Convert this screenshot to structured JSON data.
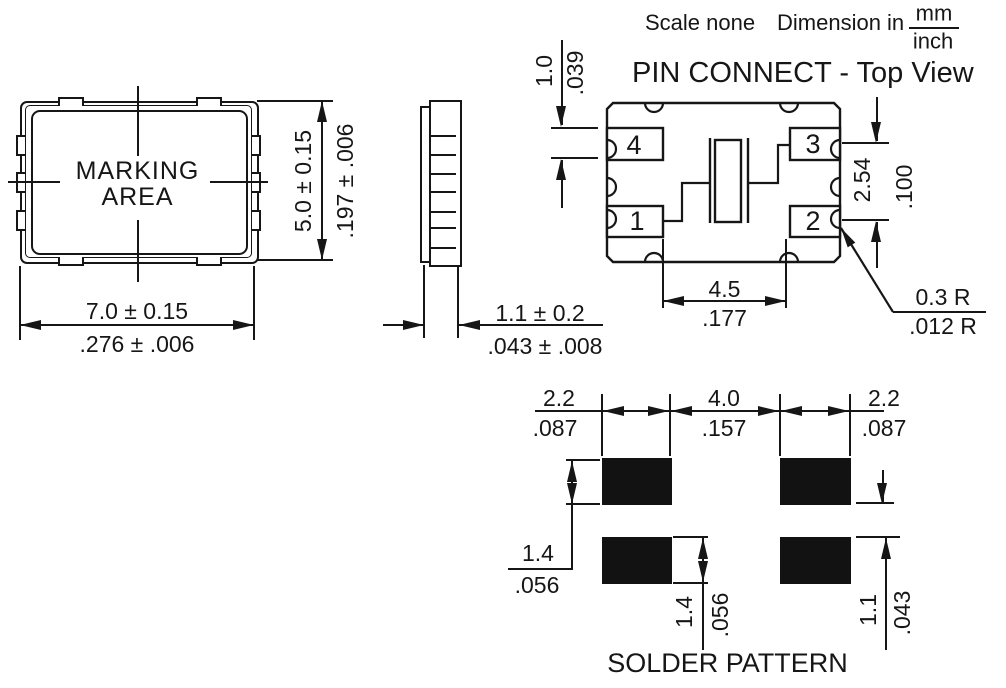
{
  "header": {
    "scale_label": "Scale none",
    "dimension_label": "Dimension in",
    "unit_numerator": "mm",
    "unit_denominator": "inch"
  },
  "package_view": {
    "marking_line1": "MARKING",
    "marking_line2": "AREA",
    "width": {
      "mm": "7.0 ± 0.15",
      "inch": ".276 ± .006"
    },
    "height": {
      "mm": "5.0 ± 0.15",
      "inch": ".197 ± .006"
    }
  },
  "side_view": {
    "thickness": {
      "mm": "1.1 ± 0.2",
      "inch": ".043 ± .008"
    }
  },
  "pin_connect": {
    "title": "PIN CONNECT - Top View",
    "pin1": "1",
    "pin2": "2",
    "pin3": "3",
    "pin4": "4",
    "pad_height": {
      "mm": "1.0",
      "inch": ".039"
    },
    "pin_pitch": {
      "mm": "2.54",
      "inch": ".100"
    },
    "pad_span": {
      "mm": "4.5",
      "inch": ".177"
    },
    "corner_radius": {
      "mm": "0.3 R",
      "inch": ".012 R"
    }
  },
  "solder_pattern": {
    "title": "SOLDER PATTERN",
    "pad_width_left": {
      "mm": "2.2",
      "inch": ".087"
    },
    "pad_gap": {
      "mm": "4.0",
      "inch": ".157"
    },
    "pad_width_right": {
      "mm": "2.2",
      "inch": ".087"
    },
    "pad_height_upper": {
      "mm": "1.4",
      "inch": ".056"
    },
    "pad_height_lower": {
      "mm": "1.4",
      "inch": ".056"
    },
    "row_gap": {
      "mm": "1.1",
      "inch": ".043"
    }
  }
}
